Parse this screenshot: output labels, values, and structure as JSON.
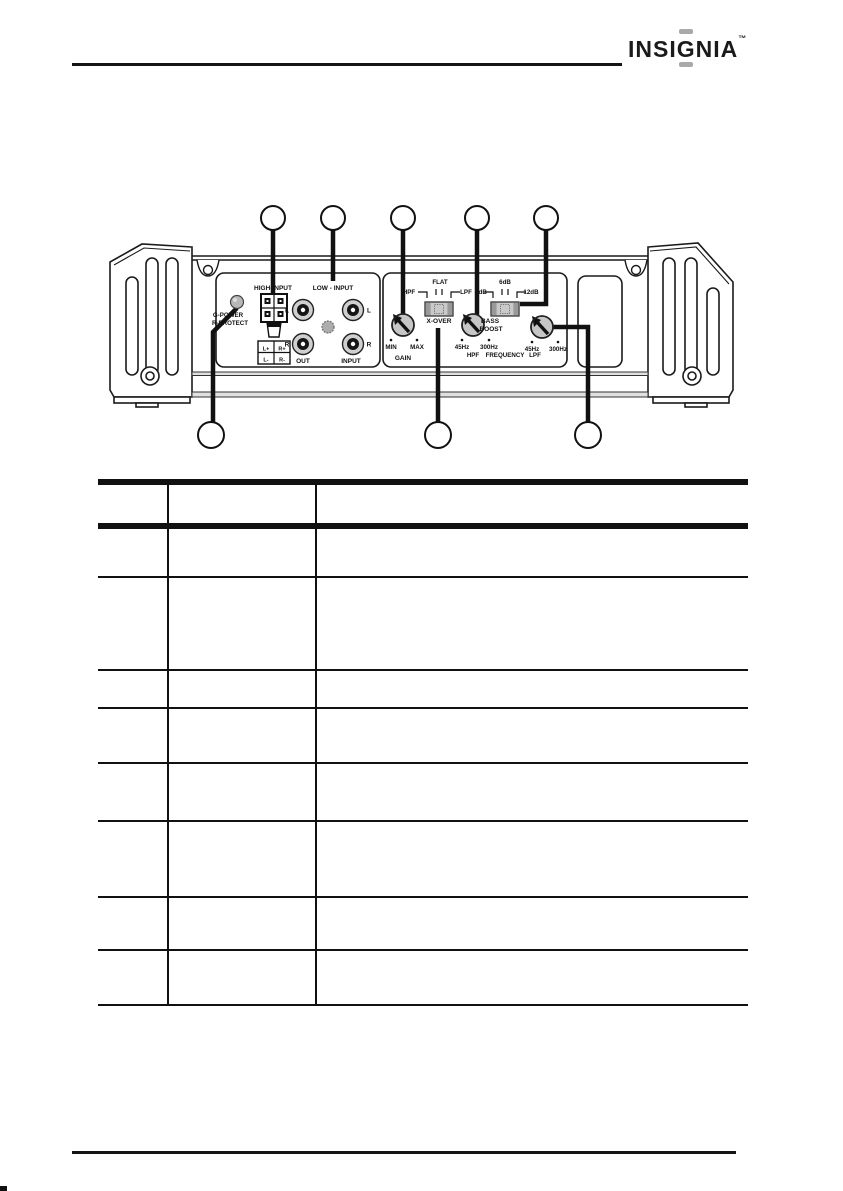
{
  "header": {
    "logo": {
      "pre": "INSI",
      "g": "G",
      "post": "NIA",
      "tm": "™"
    }
  },
  "colors": {
    "line_art": "#1a1a1a",
    "panel_gray": "#c6c6c6",
    "logo_accent": "#a9a9a9"
  },
  "diagram": {
    "led": {
      "line1": "G-POWER",
      "line2": "R-PROTECT"
    },
    "high_input": {
      "title": "HIGH-INPUT",
      "t_lplus": "L+",
      "t_rplus": "R+",
      "t_lminus": "L-",
      "t_rminus": "R-"
    },
    "low_input": {
      "title": "LOW - INPUT",
      "top_left": "L",
      "top_right": "L",
      "bot_left": "R",
      "bot_right": "R",
      "out": "OUT",
      "input": "INPUT"
    },
    "gain": {
      "min": "MIN",
      "max": "MAX",
      "label": "GAIN"
    },
    "xover": {
      "left": "HPF",
      "center": "FLAT",
      "right": "LPF",
      "label": "X-OVER"
    },
    "bass_boost": {
      "left": "0dB",
      "center": "6dB",
      "right": "12dB",
      "line1": "BASS",
      "line2": "BOOST"
    },
    "hpf_freq": {
      "low": "45Hz",
      "high": "300Hz"
    },
    "lpf_freq": {
      "low": "45Hz",
      "high": "300Hz"
    },
    "freq_row": {
      "hpf": "HPF",
      "label": "FREQUENCY",
      "lpf": "LPF"
    },
    "callouts": {
      "top_count": 5,
      "bottom_count": 3,
      "labels": [
        "",
        "",
        "",
        "",
        "",
        "",
        "",
        ""
      ]
    }
  },
  "table": {
    "header": [
      "",
      "",
      ""
    ],
    "rows": [
      [
        "",
        "",
        ""
      ],
      [
        "",
        "",
        ""
      ],
      [
        "",
        "",
        ""
      ],
      [
        "",
        "",
        ""
      ],
      [
        "",
        "",
        ""
      ],
      [
        "",
        "",
        ""
      ],
      [
        "",
        "",
        ""
      ],
      [
        "",
        "",
        ""
      ]
    ]
  }
}
